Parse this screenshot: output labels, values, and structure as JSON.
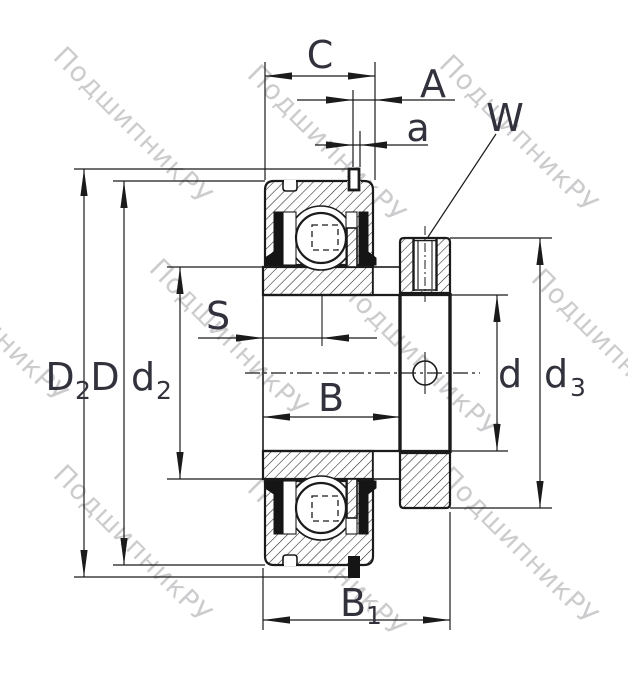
{
  "watermark": {
    "text": "ПодшипникРУ"
  },
  "colors": {
    "line": "#1b1b1b",
    "label": "#31323c",
    "watermark": "#9b9ba1",
    "background": "#ffffff"
  },
  "dimension_labels": {
    "C": {
      "main": "C",
      "sub": ""
    },
    "A": {
      "main": "A",
      "sub": ""
    },
    "a": {
      "main": "a",
      "sub": ""
    },
    "W": {
      "main": "W",
      "sub": ""
    },
    "S": {
      "main": "S",
      "sub": ""
    },
    "B": {
      "main": "B",
      "sub": ""
    },
    "B1": {
      "main": "B",
      "sub": "1"
    },
    "D2": {
      "main": "D",
      "sub": "2"
    },
    "D": {
      "main": "D",
      "sub": ""
    },
    "d2": {
      "main": "d",
      "sub": "2"
    },
    "d": {
      "main": "d",
      "sub": ""
    },
    "d3": {
      "main": "d",
      "sub": "3"
    }
  }
}
